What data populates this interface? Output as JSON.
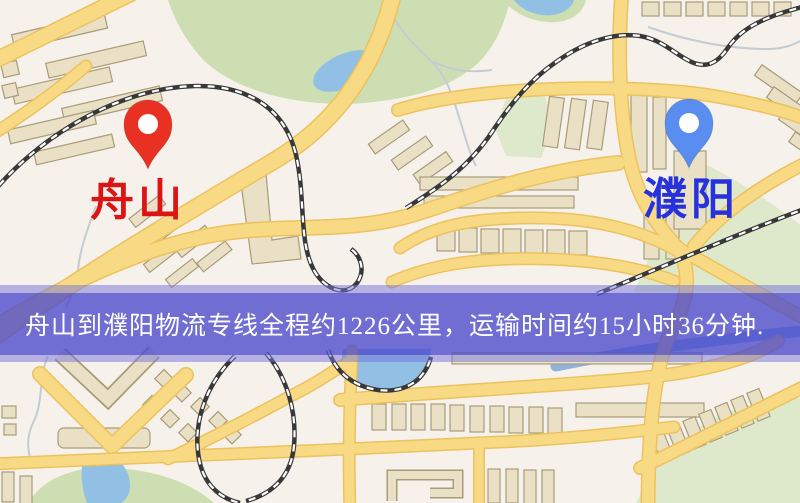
{
  "map": {
    "origin_label": "舟山",
    "destination_label": "濮阳",
    "origin_pin_color": "#e93123",
    "destination_pin_color": "#5a8df0",
    "origin_label_color": "#dd1414",
    "destination_label_color": "#2732dc"
  },
  "banner": {
    "text": "舟山到濮阳物流专线全程约1226公里，运输时间约15小时36分钟.",
    "origin": "舟山",
    "destination": "濮阳",
    "distance_km": "1226",
    "duration_hours": "15",
    "duration_minutes": "36",
    "text_color": "#ffffff"
  },
  "palette": {
    "background": "#f7f1ec",
    "road_fill": "#f8da85",
    "road_casing": "#edc25e",
    "park": "#cddfb2",
    "park_pale": "#dde9ca",
    "water": "#92bfe4",
    "river": "#8db4da",
    "stream": "#c3ccd2",
    "railway": "#383838",
    "railway_dash": "#ffffff",
    "building": "#e9e0c6",
    "building_outline": "#a89c77",
    "banner_outer": "rgba(115,115,218,0.50)",
    "banner_inner": "rgba(54,54,198,0.55)"
  }
}
